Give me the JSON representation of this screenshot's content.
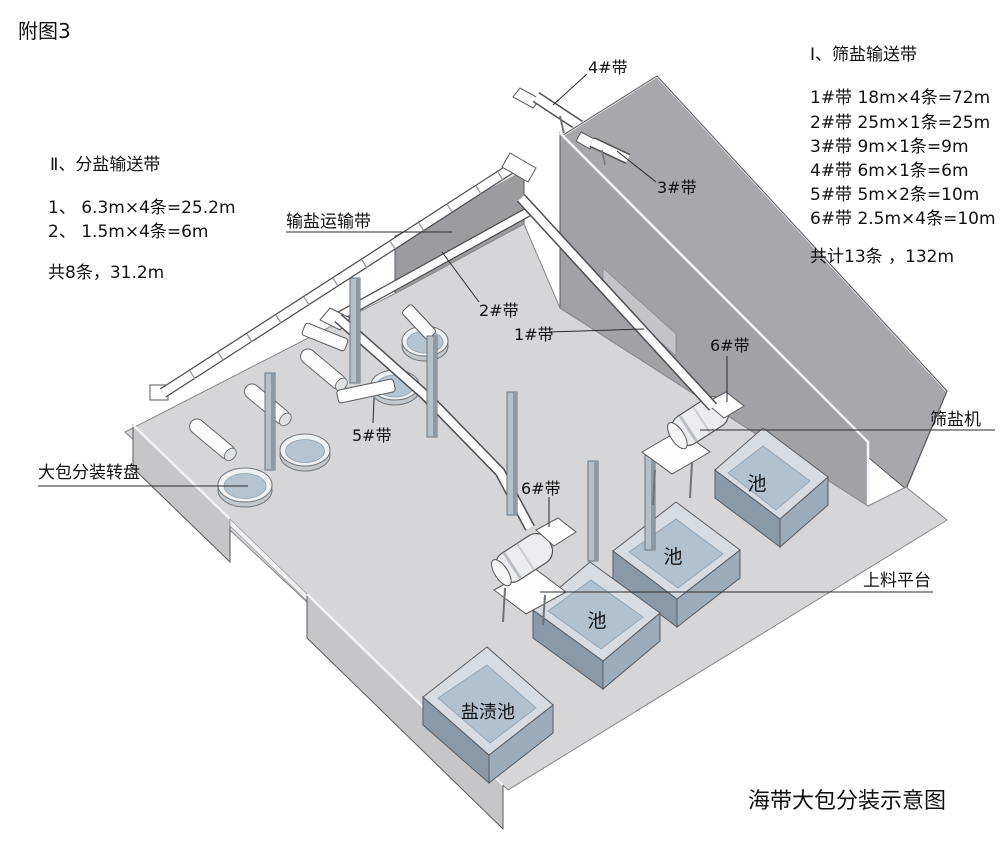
{
  "figure_tag": "附图3",
  "title": "海带大包分装示意图",
  "legend_right": {
    "heading": "Ⅰ、筛盐输送带",
    "items": [
      "1#带  18m×4条=72m",
      "2#带  25m×1条=25m",
      "3#带  9m×1条=9m",
      "4#带  6m×1条=6m",
      "5#带  5m×2条=10m",
      "6#带  2.5m×4条=10m"
    ],
    "total": "共计13条 ，132m"
  },
  "legend_left": {
    "heading": "Ⅱ、分盐输送带",
    "items": [
      "1、 6.3m×4条=25.2m",
      "2、 1.5m×4条=6m"
    ],
    "total": "共8条，31.2m"
  },
  "labels": {
    "belt1": "1#带",
    "belt2": "2#带",
    "belt3": "3#带",
    "belt4": "4#带",
    "belt5": "5#带",
    "belt6_center": "6#带",
    "belt6_right": "6#带",
    "salt_transport_belt": "输盐运输带",
    "sieve_machine": "筛盐机",
    "turntable": "大包分装转盘",
    "platform": "上料平台",
    "tank": "池",
    "salt_pickle_tank": "盐渍池"
  },
  "colors": {
    "wall_gray": "#a8a8ac",
    "floor_gray": "#d6d6d9",
    "tank_rim": "#d6dce2",
    "tank_inner": "#b2c1ce",
    "tank_face_dark": "#8a99a8",
    "belt_white": "#fdfdfd",
    "text": "#111111"
  }
}
